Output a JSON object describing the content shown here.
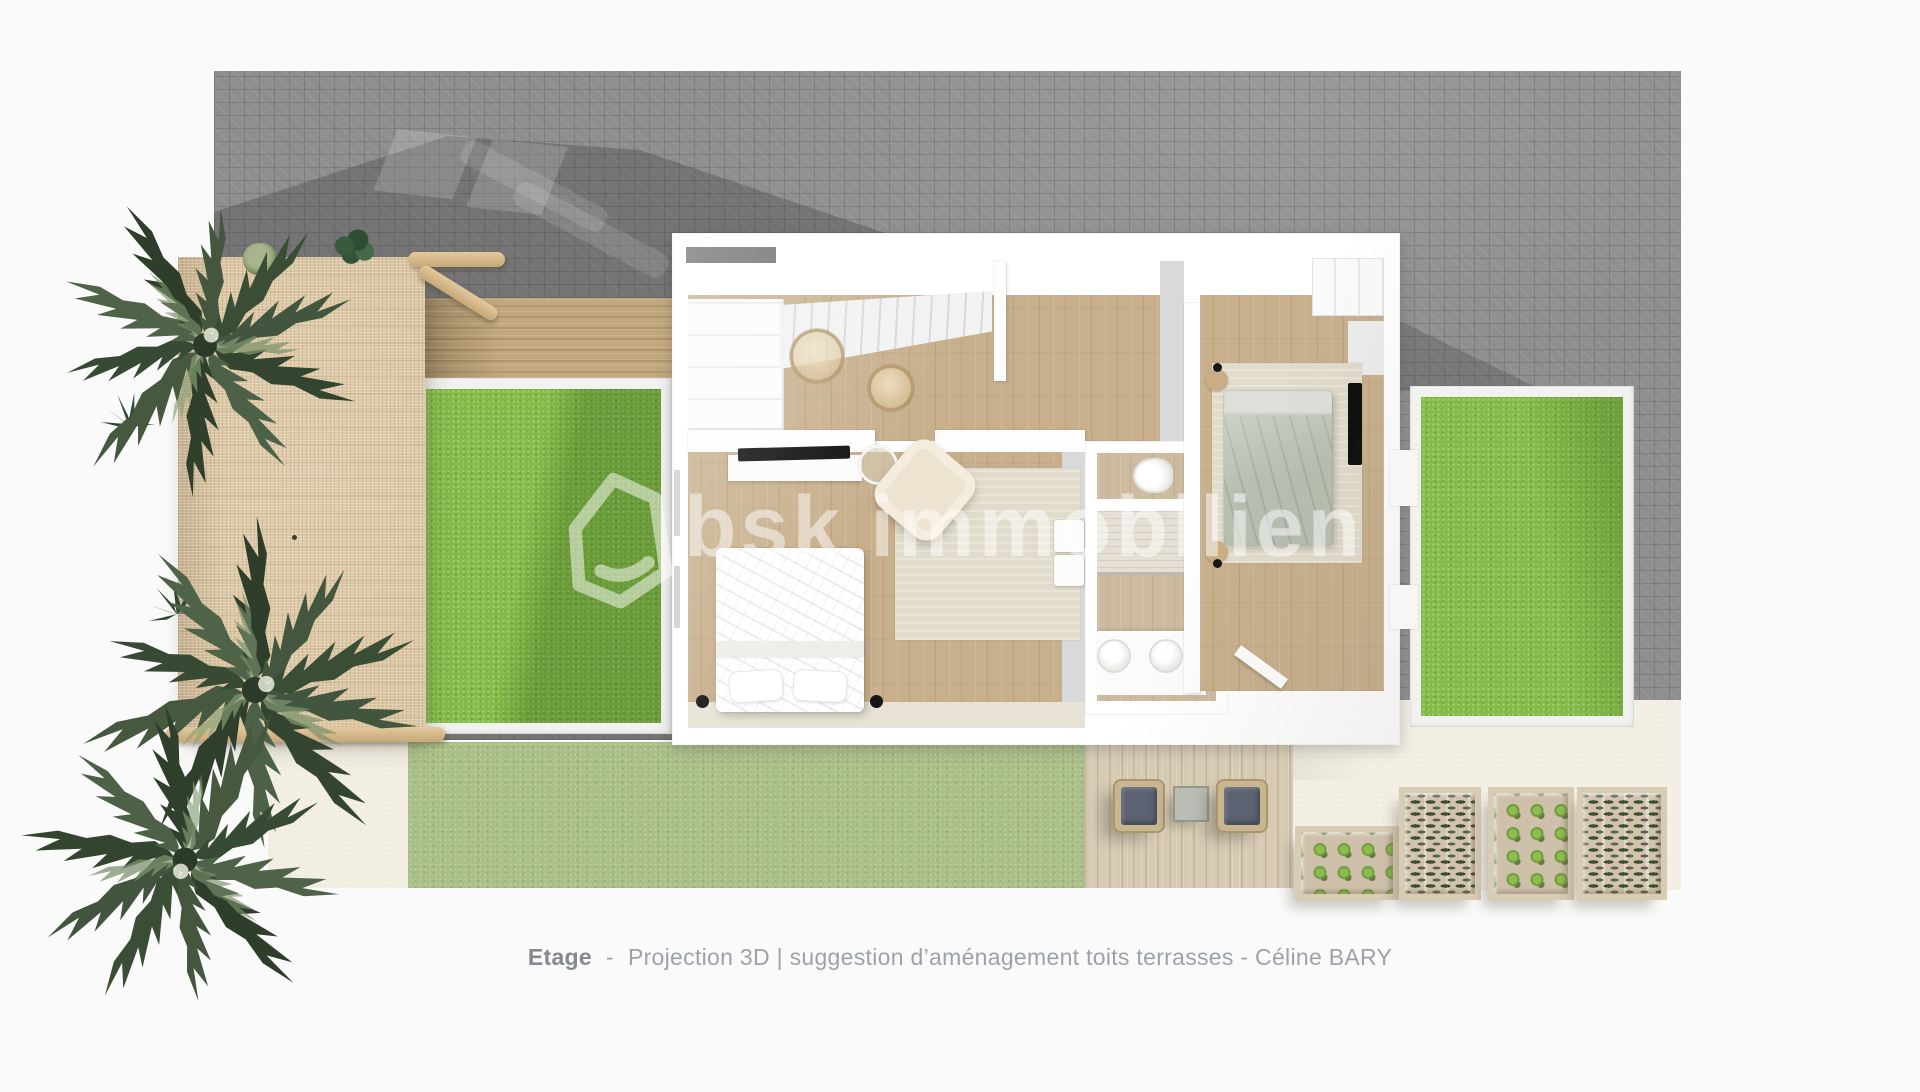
{
  "watermark": {
    "icon": "house-outline-icon",
    "brand_prefix": "bsk",
    "brand_suffix": "immobilien"
  },
  "caption": {
    "label": "Etage",
    "separator": "-",
    "text": "Projection 3D | suggestion d’aménagement toits terrasses - Céline BARY"
  },
  "palette": {
    "background": "#fafafa",
    "paving_gray": "#8e8e8e",
    "cast_shadow": "rgba(35,35,35,0.24)",
    "terrace_grass": "#85bb47",
    "garden_grass": "#aabe87",
    "cream_ground": "#f3efe4",
    "pergola_rattan": "#d9c29c",
    "deck_upper_wood": "#c2a87e",
    "deck_lower_wood": "#d7cab3",
    "interior_wood": "#c8b08d",
    "walls": "#ffffff",
    "bed_sage": "#b6bfb1",
    "bed_white": "#ffffff",
    "cushion_slate": "#5b6372",
    "rug_beige": "#e1dbcb",
    "tv_black": "#111111",
    "watermark_white": "rgba(255,255,255,0.42)",
    "caption_gray": "#9da1a8",
    "palm_green": "#3a4d35"
  }
}
